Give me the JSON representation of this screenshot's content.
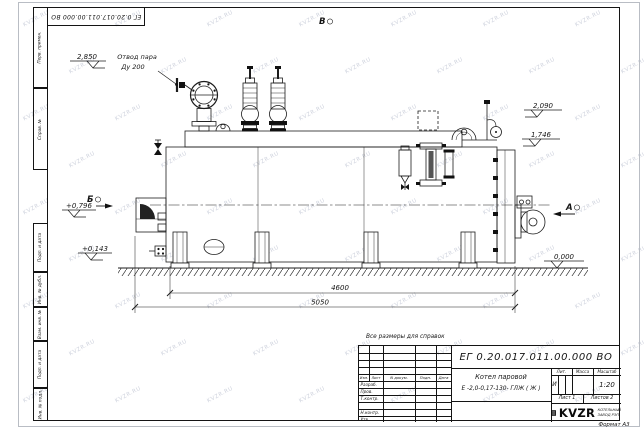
{
  "watermark": {
    "text": "KVZR.RU"
  },
  "sheet": {
    "top_stamp": "ЕГ 0.20.017.011.00.000  ВО",
    "margin_fields": [
      "Перв. примен.",
      "Справ. №",
      "Подп. и дата",
      "Инв. № дубл.",
      "Взам. инв. №",
      "Подп. и дата",
      "Инв. № подл."
    ],
    "format_note": "Формат А3",
    "reference_note": "Все размеры для справок"
  },
  "drawing": {
    "callout": {
      "line1": "Отвод пара",
      "line2": "Ду 200"
    },
    "views": {
      "top": "В",
      "left": "Б",
      "right": "А"
    },
    "elevations": {
      "steam_outlet": "2,850",
      "boiler_top": "2,090",
      "casing_top": "1,746",
      "ground": "0,000",
      "front_upper": "+0,796",
      "front_lower": "+0,143"
    },
    "dimensions": {
      "inner_length": "4600",
      "overall_length": "5050"
    }
  },
  "title_block": {
    "designation": "ЕГ 0.20.017.011.00.000  ВО",
    "product_line1": "Котел паровой",
    "product_line2": "Е -2,0-0,17-130- ГЛЖ ( Ж )",
    "header_cols": [
      "Изм.",
      "Лист",
      "N докум.",
      "Подп.",
      "Дата"
    ],
    "signature_rows": [
      "Разраб.",
      "Пров.",
      "Т.контр.",
      "Н.контр.",
      "Утв."
    ],
    "lit_label": "Лит.",
    "lit_value": "И",
    "mass_label": "Масса",
    "scale_label": "Масштаб",
    "scale_value": "1:20",
    "sheet_no": "Лист 1",
    "sheets_total": "Листов 2",
    "company": {
      "logo": "KVZR",
      "tagline1": "КОТЕЛЬНЫЙ",
      "tagline2": "ЗАВОД РЭП"
    }
  }
}
